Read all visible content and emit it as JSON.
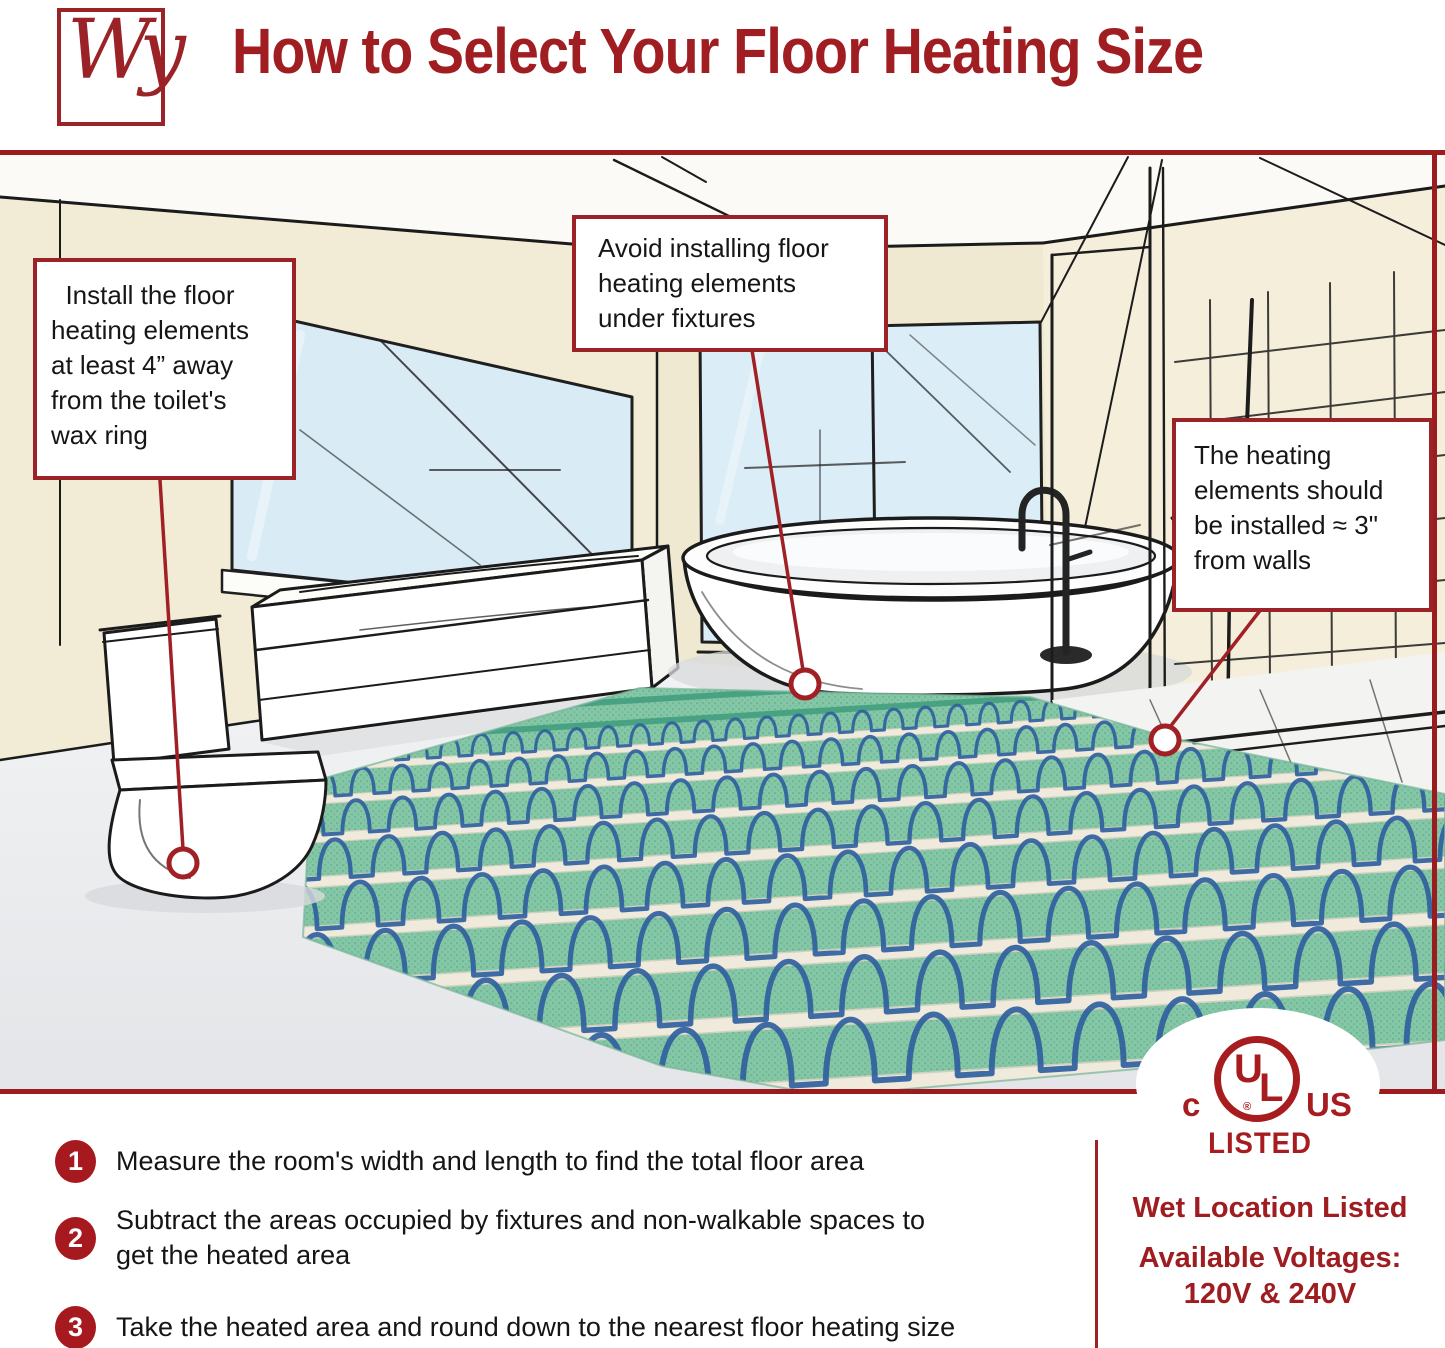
{
  "header": {
    "logo": "Wy",
    "title": "How to Select Your Floor Heating Size"
  },
  "callouts": {
    "toilet_clearance": "  Install the floor\nheating elements\nat least 4” away\nfrom the toilet's\nwax ring",
    "fixtures": "Avoid installing floor\nheating elements\nunder fixtures",
    "wall_clearance": "The heating\nelements should\nbe installed ≈ 3\"\nfrom walls"
  },
  "steps": [
    {
      "number": "1",
      "text": "Measure the room's width and length to find the total floor area"
    },
    {
      "number": "2",
      "text": "Subtract the areas occupied by fixtures and non-walkable spaces to\nget the heated area"
    },
    {
      "number": "3",
      "text": "Take the heated area and round down to the nearest floor heating size"
    }
  ],
  "certification": {
    "c": "c",
    "u": "U",
    "l": "L",
    "registered": "®",
    "us": "US",
    "listed": "LISTED"
  },
  "footer_right": {
    "wet_location": "Wet Location Listed",
    "voltages_label": "Available Voltages:",
    "voltages_value": "120V & 240V"
  },
  "colors": {
    "brand_red": "#9e1d21",
    "accent_red": "#a02026",
    "mat_green": "#85c7a6",
    "cable_blue": "#30609e",
    "wall_cream": "#f2ecd6",
    "window_blue": "#d9ecf5"
  }
}
